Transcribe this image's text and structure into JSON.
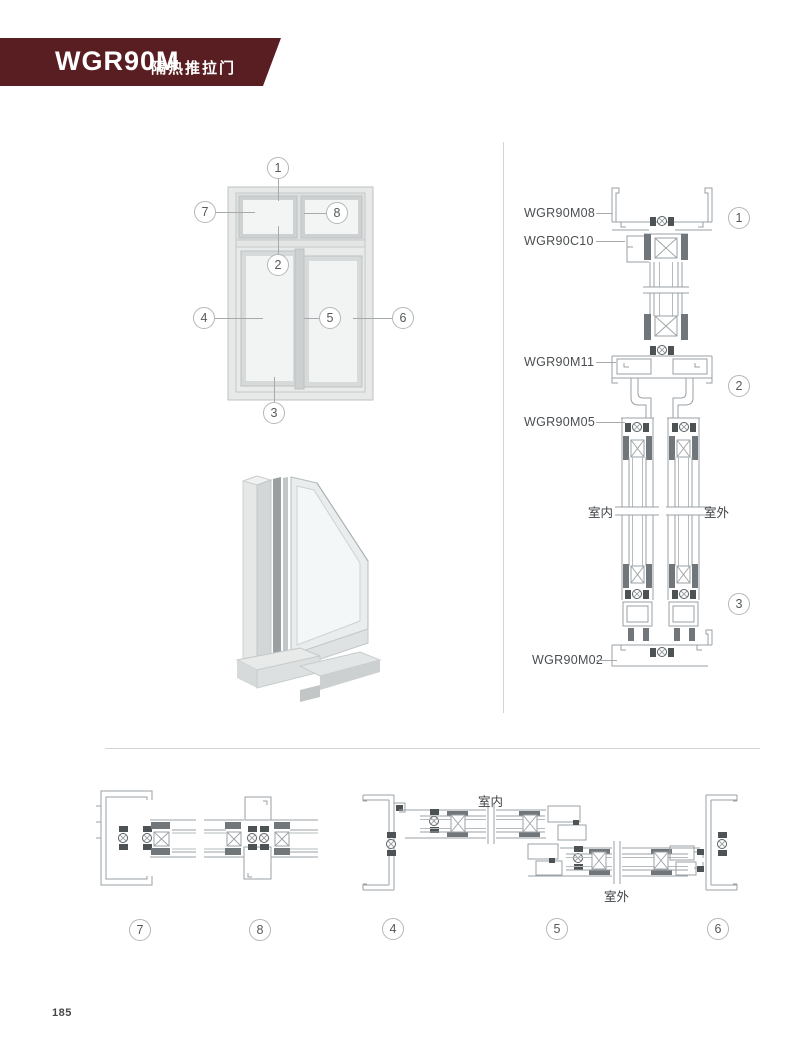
{
  "colors": {
    "banner_red": "#581e22",
    "cad_line_gray": "#9ba1a4",
    "divider_gray": "#d2d4d6"
  },
  "header": {
    "model": "WGR90M",
    "subtitle": "隔热推拉门"
  },
  "elevation": {
    "callouts": [
      "1",
      "7",
      "8",
      "2",
      "4",
      "5",
      "6",
      "3"
    ]
  },
  "vertical_section": {
    "labels": [
      "WGR90M08",
      "WGR90C10",
      "WGR90M11",
      "WGR90M05",
      "WGR90M02"
    ],
    "indoor": "室内",
    "outdoor": "室外",
    "callouts": [
      "1",
      "2",
      "3"
    ]
  },
  "horizontal_section": {
    "indoor": "室内",
    "outdoor": "室外",
    "callouts": [
      "7",
      "8",
      "4",
      "5",
      "6"
    ]
  },
  "footer": {
    "page_number": "185"
  }
}
